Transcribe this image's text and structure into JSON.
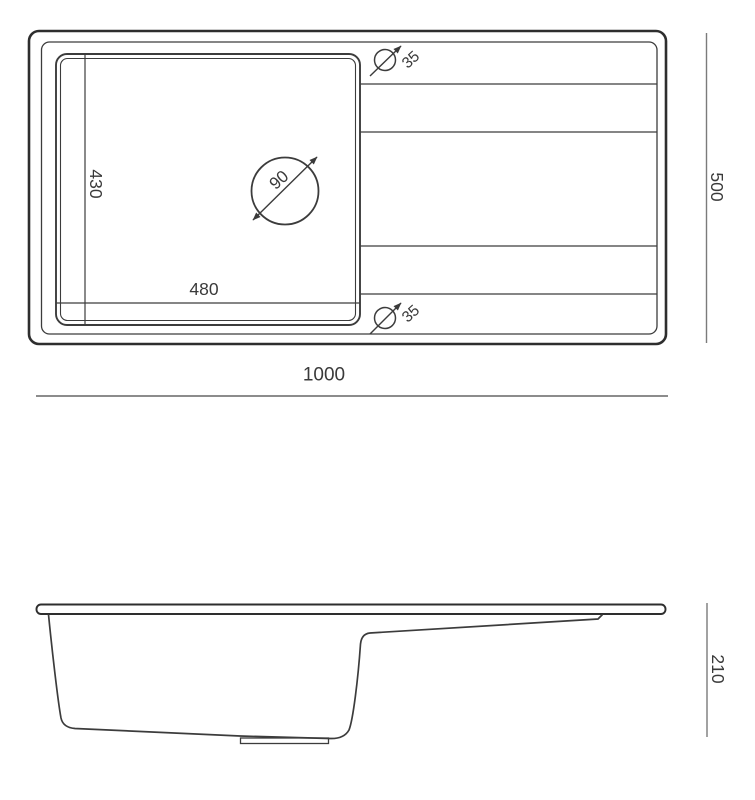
{
  "drawing": {
    "type": "sink-technical-drawing",
    "background_color": "#ffffff",
    "line_color": "#2e2e2e",
    "dimension_line_color": "#7b7b7b",
    "text_color": "#3a3a3a"
  },
  "top_view": {
    "overall_width_mm": "1000",
    "overall_depth_mm": "500",
    "bowl_width_mm": "480",
    "bowl_depth_mm": "430",
    "drain_hole": {
      "symbol_icon": "diameter-icon",
      "diameter_mm": "90"
    },
    "tap_hole_top": {
      "symbol_icon": "diameter-icon",
      "diameter_mm": "35"
    },
    "tap_hole_bottom": {
      "symbol_icon": "diameter-icon",
      "diameter_mm": "35"
    }
  },
  "side_view": {
    "overall_height_mm": "210"
  }
}
